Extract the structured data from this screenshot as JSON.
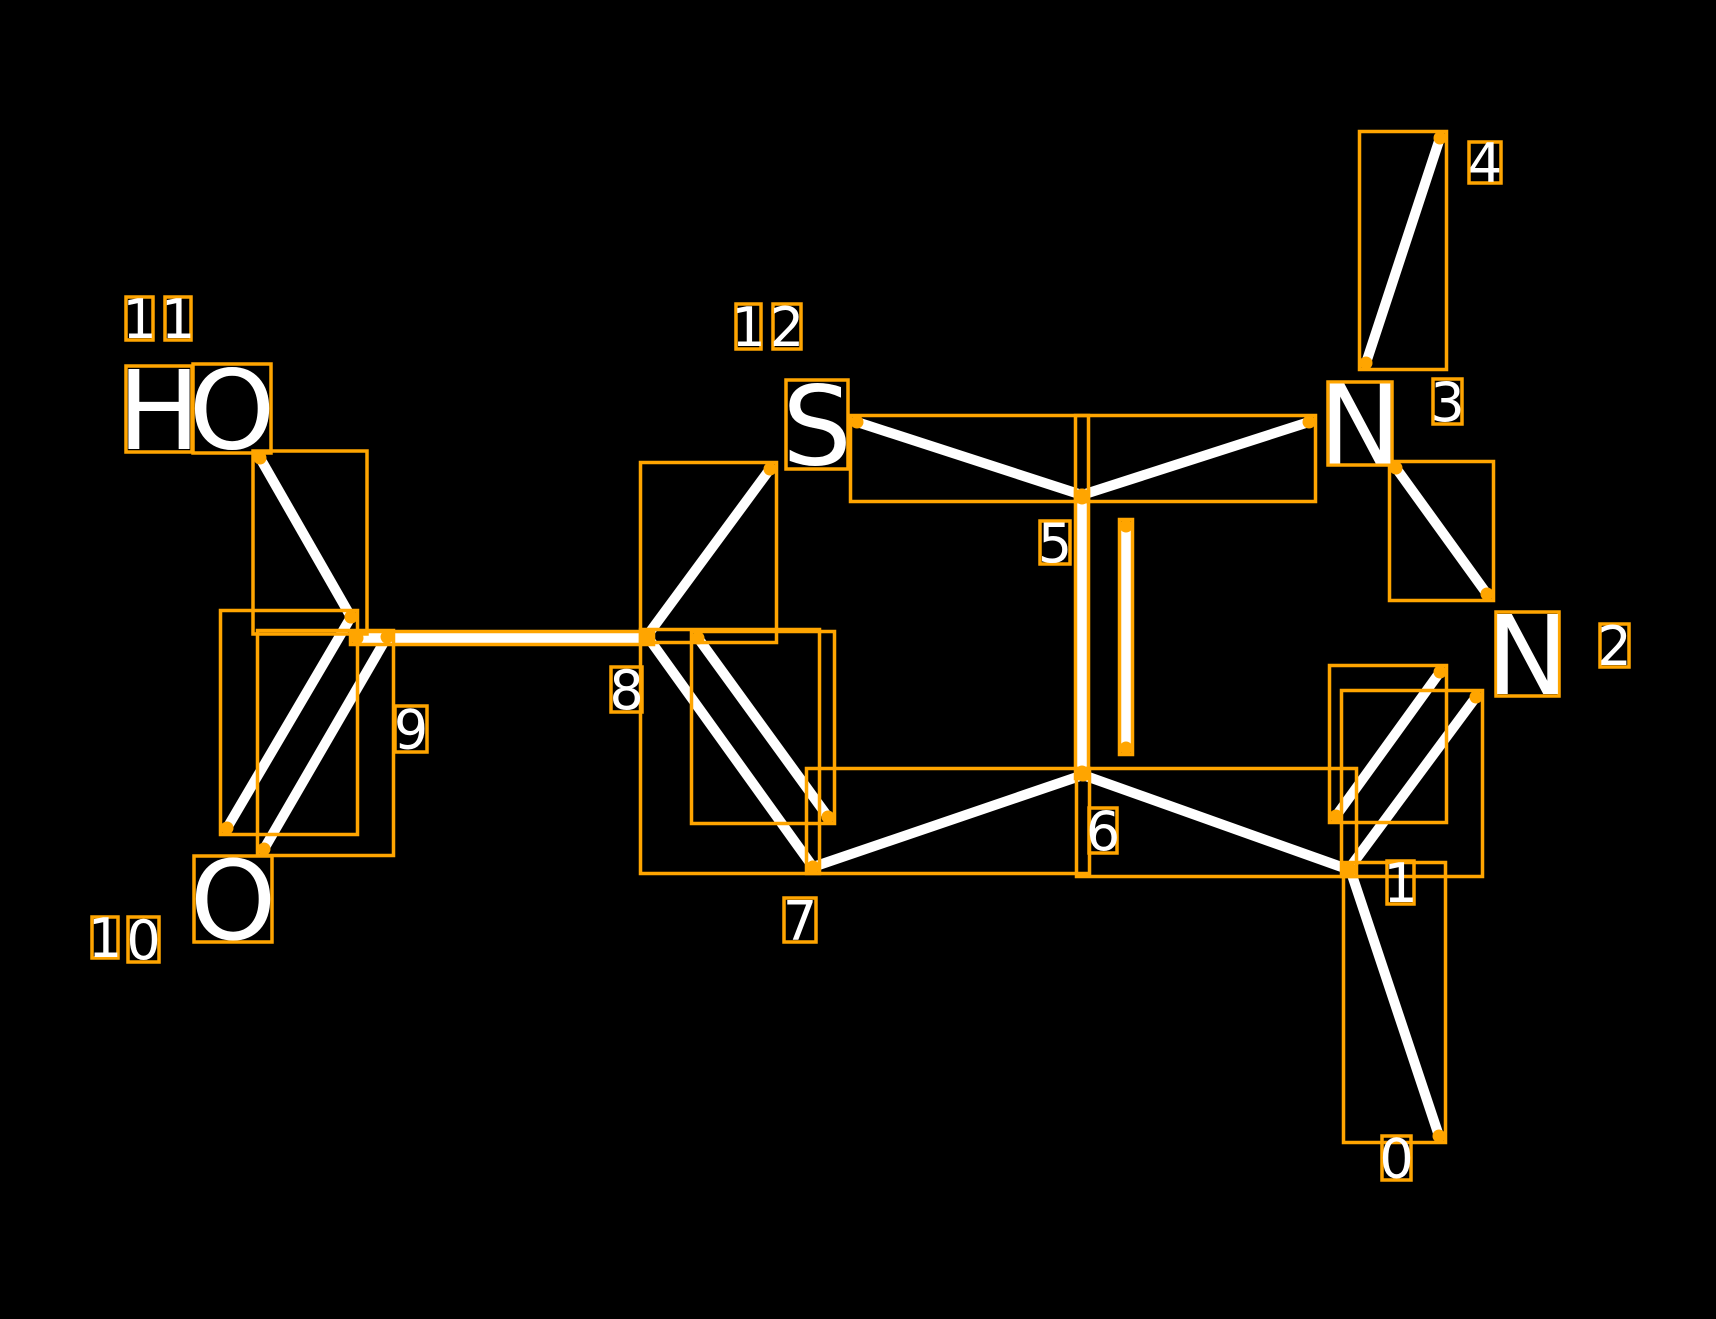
{
  "canvas": {
    "width": 1716,
    "height": 1319
  },
  "colors": {
    "background": "#000000",
    "bond": "#ffffff",
    "annotation": "#ffa500",
    "atom_text": "#ffffff",
    "label_text": "#ffffff"
  },
  "style": {
    "bond_width": 10,
    "box_stroke": 3.5,
    "box_pad": 6.5,
    "dot_radius": 6.5,
    "atom_font_size": 110,
    "label_font_size": 54
  },
  "molecule": {
    "atoms": [
      {
        "id": "atom-11-hydroxyl",
        "symbol": "HO",
        "chars": [
          {
            "char": "H",
            "x": 126,
            "y": 366,
            "w": 66,
            "h": 86
          },
          {
            "char": "O",
            "x": 193,
            "y": 364,
            "w": 78,
            "h": 89
          }
        ]
      },
      {
        "id": "atom-10-oxygen",
        "symbol": "O",
        "chars": [
          {
            "char": "O",
            "x": 194,
            "y": 856,
            "w": 78,
            "h": 86
          }
        ]
      },
      {
        "id": "atom-12-sulfur",
        "symbol": "S",
        "chars": [
          {
            "char": "S",
            "x": 786,
            "y": 380,
            "w": 62,
            "h": 89
          }
        ]
      },
      {
        "id": "atom-3-nitrogen",
        "symbol": "N",
        "chars": [
          {
            "char": "N",
            "x": 1328,
            "y": 382,
            "w": 64,
            "h": 83
          }
        ]
      },
      {
        "id": "atom-2-nitrogen",
        "symbol": "N",
        "chars": [
          {
            "char": "N",
            "x": 1496,
            "y": 612,
            "w": 63,
            "h": 84
          }
        ]
      }
    ],
    "bonds": [
      {
        "id": "bond-11-9",
        "x1": 260,
        "y1": 458,
        "x2": 351,
        "y2": 617,
        "box": [
          253,
          451,
          367,
          634
        ]
      },
      {
        "id": "bond-9-10-outer",
        "x1": 351,
        "y1": 617,
        "x2": 227,
        "y2": 828
      },
      {
        "id": "bond-9-10-inner",
        "x1": 387,
        "y1": 637,
        "x2": 264,
        "y2": 849
      },
      {
        "id": "bond-9-8",
        "x1": 357,
        "y1": 638,
        "x2": 647,
        "y2": 638
      },
      {
        "id": "bond-8-12",
        "x1": 647,
        "y1": 636,
        "x2": 770,
        "y2": 469
      },
      {
        "id": "bond-8-7-outer",
        "x1": 647,
        "y1": 636,
        "x2": 813,
        "y2": 867
      },
      {
        "id": "bond-8-7-inner",
        "x1": 698,
        "y1": 638,
        "x2": 828,
        "y2": 817
      },
      {
        "id": "bond-7-6",
        "x1": 813,
        "y1": 867,
        "x2": 1083,
        "y2": 775
      },
      {
        "id": "bond-6-5-outer",
        "x1": 1082,
        "y1": 772,
        "x2": 1082,
        "y2": 498
      },
      {
        "id": "bond-6-5-inner",
        "x1": 1126,
        "y1": 748,
        "x2": 1126,
        "y2": 526
      },
      {
        "id": "bond-12-5",
        "x1": 857,
        "y1": 422,
        "x2": 1082,
        "y2": 495
      },
      {
        "id": "bond-5-3",
        "x1": 1082,
        "y1": 495,
        "x2": 1309,
        "y2": 422
      },
      {
        "id": "bond-3-4",
        "x1": 1366,
        "y1": 363,
        "x2": 1440,
        "y2": 138
      },
      {
        "id": "bond-3-2",
        "x1": 1396,
        "y1": 468,
        "x2": 1487,
        "y2": 594
      },
      {
        "id": "bond-2-1-outer",
        "x1": 1476,
        "y1": 697,
        "x2": 1348,
        "y2": 870
      },
      {
        "id": "bond-2-1-inner",
        "x1": 1440,
        "y1": 672,
        "x2": 1336,
        "y2": 816
      },
      {
        "id": "bond-6-1",
        "x1": 1083,
        "y1": 775,
        "x2": 1350,
        "y2": 870
      },
      {
        "id": "bond-1-0",
        "x1": 1350,
        "y1": 869,
        "x2": 1439,
        "y2": 1136
      }
    ],
    "index_labels": [
      {
        "text": "0",
        "digits": [
          {
            "char": "0",
            "x": 1382,
            "y": 1136,
            "w": 29,
            "h": 44
          }
        ]
      },
      {
        "text": "1",
        "digits": [
          {
            "char": "1",
            "x": 1387,
            "y": 861,
            "w": 27,
            "h": 43
          }
        ]
      },
      {
        "text": "2",
        "digits": [
          {
            "char": "2",
            "x": 1600,
            "y": 624,
            "w": 29,
            "h": 43
          }
        ]
      },
      {
        "text": "3",
        "digits": [
          {
            "char": "3",
            "x": 1433,
            "y": 379,
            "w": 29,
            "h": 45
          }
        ]
      },
      {
        "text": "4",
        "digits": [
          {
            "char": "4",
            "x": 1469,
            "y": 142,
            "w": 32,
            "h": 41
          }
        ]
      },
      {
        "text": "5",
        "digits": [
          {
            "char": "5",
            "x": 1040,
            "y": 521,
            "w": 30,
            "h": 43
          }
        ]
      },
      {
        "text": "6",
        "digits": [
          {
            "char": "6",
            "x": 1089,
            "y": 808,
            "w": 28,
            "h": 45
          }
        ]
      },
      {
        "text": "7",
        "digits": [
          {
            "char": "7",
            "x": 784,
            "y": 898,
            "w": 32,
            "h": 44
          }
        ]
      },
      {
        "text": "8",
        "digits": [
          {
            "char": "8",
            "x": 611,
            "y": 667,
            "w": 31,
            "h": 45
          }
        ]
      },
      {
        "text": "9",
        "digits": [
          {
            "char": "9",
            "x": 395,
            "y": 706,
            "w": 32,
            "h": 46
          }
        ]
      },
      {
        "text": "10",
        "digits": [
          {
            "char": "1",
            "x": 92,
            "y": 917,
            "w": 26,
            "h": 41
          },
          {
            "char": "0",
            "x": 128,
            "y": 917,
            "w": 31,
            "h": 45
          }
        ]
      },
      {
        "text": "11",
        "digits": [
          {
            "char": "1",
            "x": 126,
            "y": 297,
            "w": 27,
            "h": 43
          },
          {
            "char": "1",
            "x": 165,
            "y": 297,
            "w": 26,
            "h": 43
          }
        ]
      },
      {
        "text": "12",
        "digits": [
          {
            "char": "1",
            "x": 736,
            "y": 304,
            "w": 25,
            "h": 45
          },
          {
            "char": "2",
            "x": 773,
            "y": 304,
            "w": 28,
            "h": 45
          }
        ]
      }
    ]
  }
}
